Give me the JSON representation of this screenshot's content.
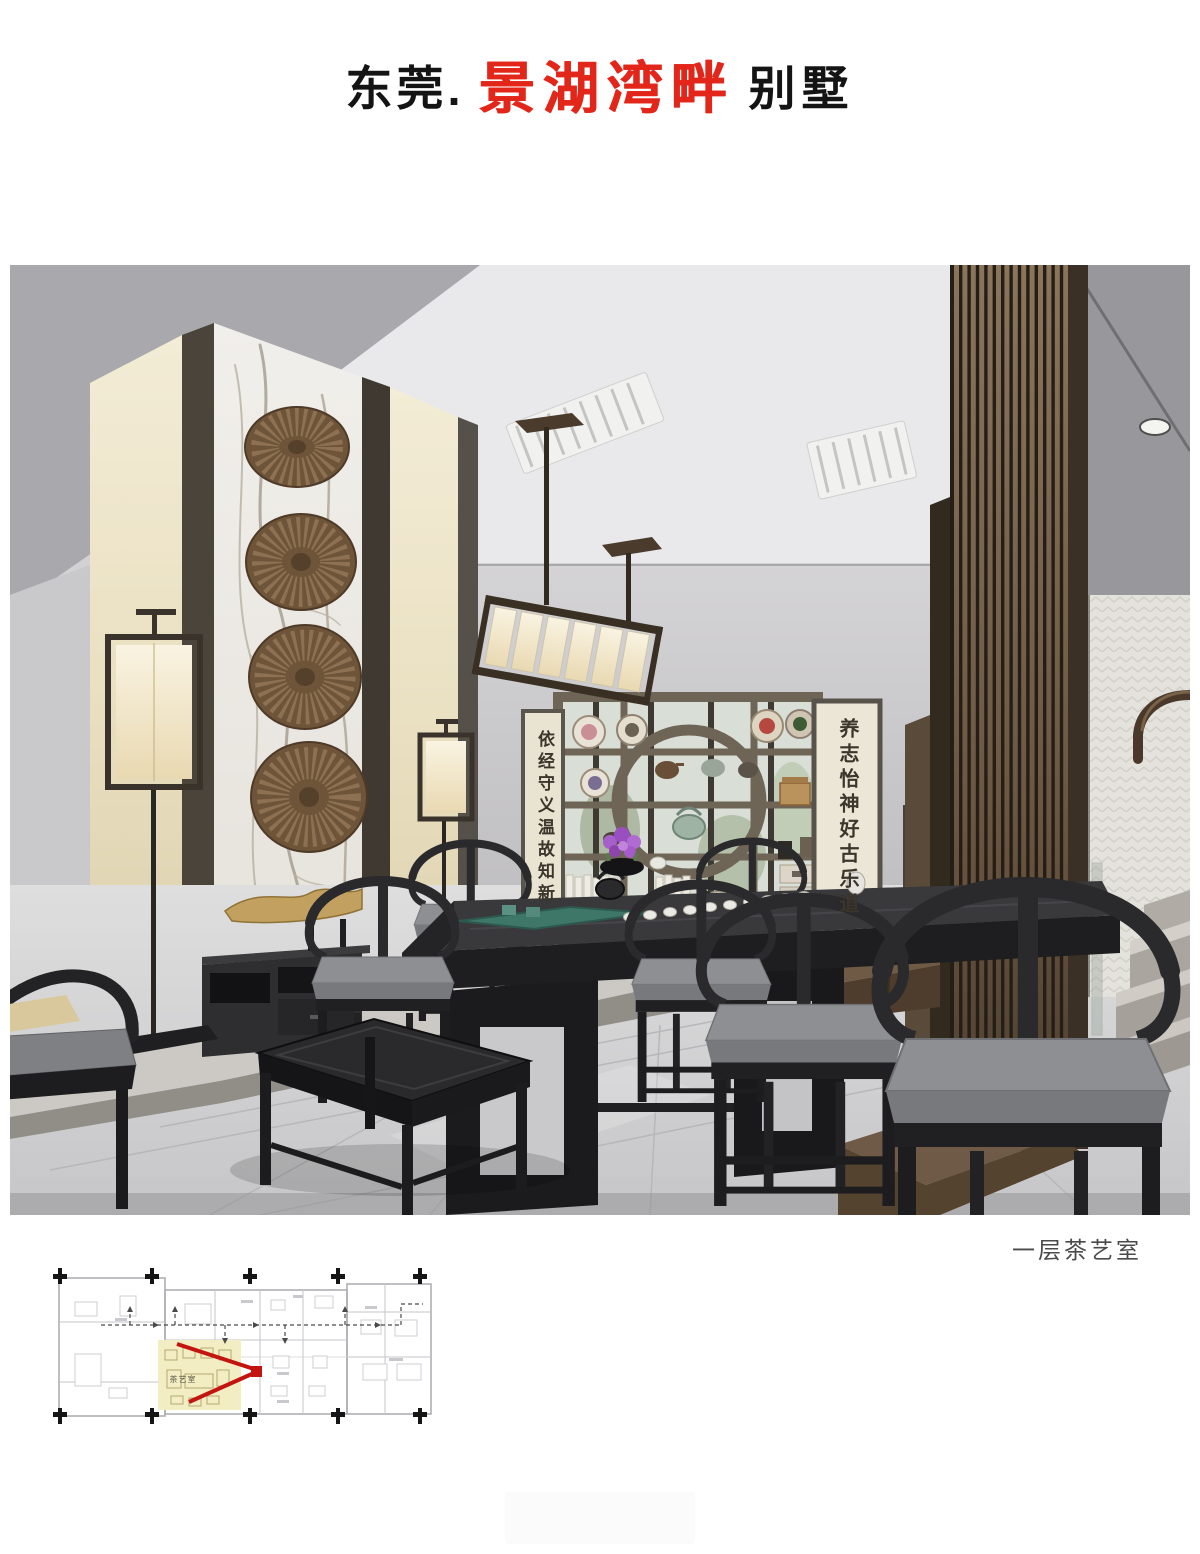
{
  "page": {
    "background": "#ffffff"
  },
  "header": {
    "city": "东莞.",
    "brand": "景湖湾畔",
    "suffix": "别墅",
    "brand_color": "#e2261a",
    "text_color": "#141414"
  },
  "photo": {
    "caption": "一层茶艺室",
    "caption_color": "#4a4a4a",
    "left_scroll_text": "依经守义温故知新",
    "right_scroll_text": "养志怡神好古乐道"
  },
  "floor_plan": {
    "highlighted_room_label": "茶艺室",
    "highlight_color": "#f3edc3",
    "view_marker_color": "#c41410",
    "column_marker_color": "#151515"
  }
}
